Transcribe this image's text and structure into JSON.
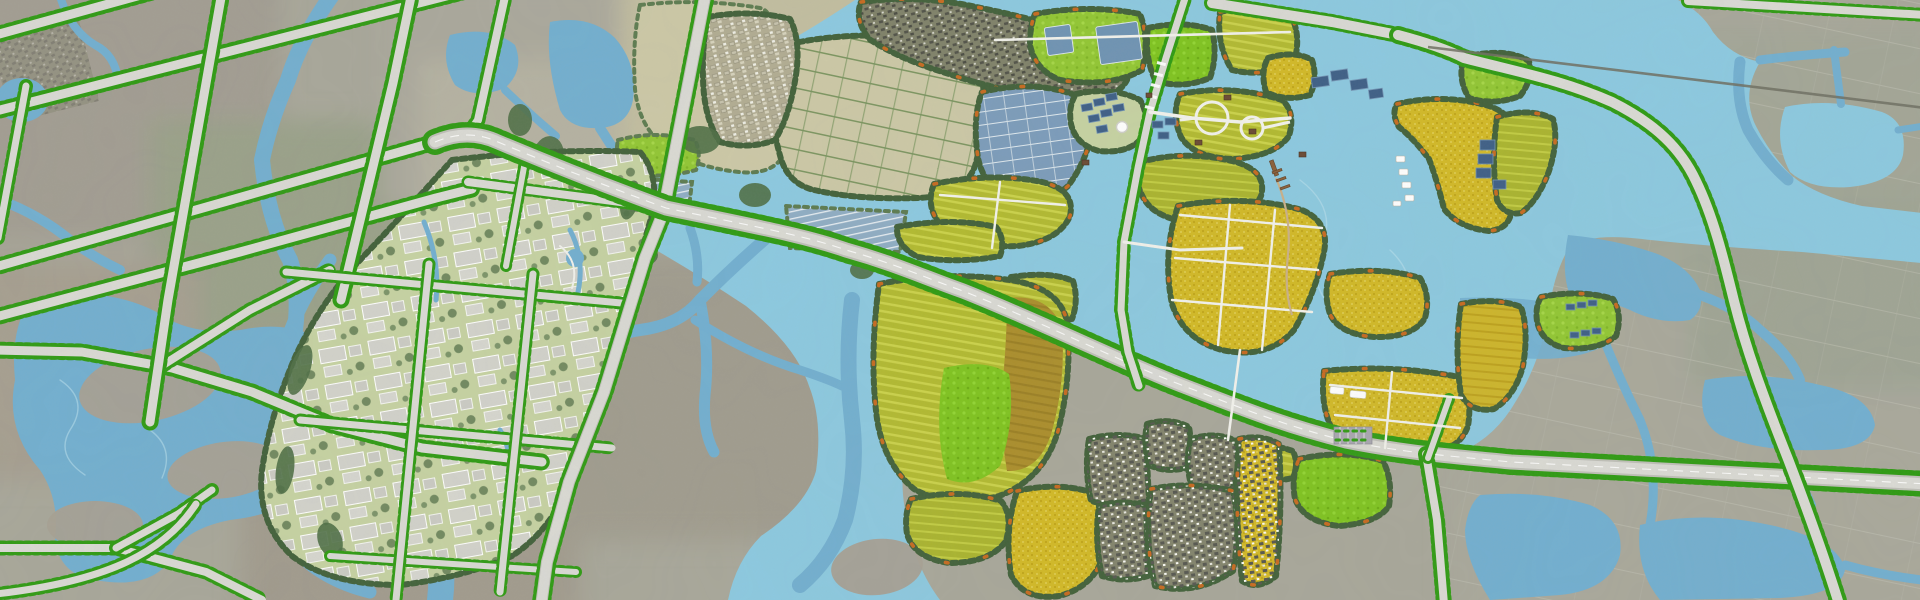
{
  "map": {
    "label": "Aerial masterplan map of a wetland park surrounded by urban grid, farmland villages and canals",
    "palette": {
      "water": "#72afd0",
      "lake": "#8cc9e0",
      "vein": "#b9e0ec",
      "road": "#dadad4",
      "road_casing": "#bfbfb8",
      "road_dark": "#6e6e62",
      "path_white": "#f2f2ec",
      "tree_dot": "#2f9b13",
      "tree_border": "#42613a",
      "orange_accent": "#cf6a1e",
      "lime": "#93c733",
      "lime_bright": "#7fc41f",
      "paddy": "#b4bc30",
      "gold": "#d3ba28",
      "olive": "#ac8e2b",
      "pond": "#7b9cbb",
      "pond_light": "#9db9cd",
      "panel": "#3e5f86",
      "bg_base": "#a8a79a",
      "bg_green": "#9aa189",
      "bg_brown": "#a29b8c",
      "pale_field": "#ccc8a6",
      "hedge": "#6e8c54",
      "lawn": "#c6d2a2",
      "building": "#d2d2cb",
      "house_dark": "#565750",
      "village_ground": "#83846c",
      "village_tan": "#b1ac92",
      "boardwalk": "#c9b089",
      "parking": "#a9a7b0",
      "tent": "#ffffff",
      "brown_building": "#6b4a33"
    },
    "features": [
      {
        "name": "urban-grid-left",
        "palette_key": "bg_base"
      },
      {
        "name": "tree-lined-road",
        "palette_key": "tree_dot"
      },
      {
        "name": "canal-network",
        "palette_key": "water"
      },
      {
        "name": "southwest-lake",
        "palette_key": "water"
      },
      {
        "name": "campus-industrial-park",
        "palette_key": "building"
      },
      {
        "name": "pale-farmland-hedgerows",
        "palette_key": "pale_field"
      },
      {
        "name": "village-north-dense",
        "palette_key": "house_dark"
      },
      {
        "name": "village-white-roofs",
        "palette_key": "village_tan"
      },
      {
        "name": "wetland-lake",
        "palette_key": "lake"
      },
      {
        "name": "rice-paddy-islands",
        "palette_key": "paddy"
      },
      {
        "name": "canola-gold-fields",
        "palette_key": "gold"
      },
      {
        "name": "lime-meadow-islands",
        "palette_key": "lime"
      },
      {
        "name": "olive-crop-fields",
        "palette_key": "olive"
      },
      {
        "name": "aquaculture-ponds",
        "palette_key": "pond"
      },
      {
        "name": "solar-panel-arrays",
        "palette_key": "panel"
      },
      {
        "name": "island-tree-belts",
        "palette_key": "tree_border"
      },
      {
        "name": "orange-accent-trees",
        "palette_key": "orange_accent"
      },
      {
        "name": "main-artery-road",
        "palette_key": "road"
      },
      {
        "name": "north-south-park-road",
        "palette_key": "road"
      },
      {
        "name": "southeast-ring-road",
        "palette_key": "road"
      },
      {
        "name": "existing-dark-road",
        "palette_key": "road_dark"
      },
      {
        "name": "village-islands-south",
        "palette_key": "village_ground"
      },
      {
        "name": "white-footpaths",
        "palette_key": "path_white"
      },
      {
        "name": "lake-pier",
        "palette_key": "boardwalk"
      },
      {
        "name": "white-tents-camp",
        "palette_key": "tent"
      }
    ]
  }
}
